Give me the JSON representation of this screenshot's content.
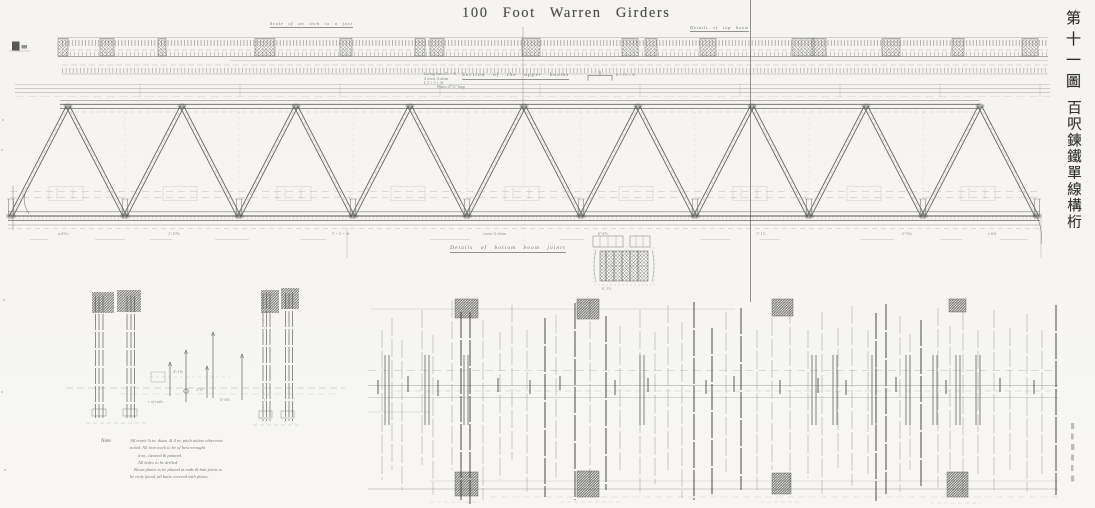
{
  "sheet": {
    "title": "100  Foot  Warren  Girders",
    "side_title_top": "第十一圖",
    "side_title_main": "百呎鍊鐵單線構桁"
  },
  "labels": {
    "scale_top_left": "Scale of an inch to a foot",
    "details_top_right": "Details  of  top  boom",
    "upper_booms": "Section  of  the  upper  booms",
    "bottom_joints": "Details  of  bottom  boom  joints",
    "note_heading": "Note"
  },
  "dimensions": {
    "stack": [
      "Lacing bars 2½ × ⅜",
      "4 rivets ⅞ diam",
      "L 3 × 3 × ⅜"
    ],
    "plate": "Plates 27′ 6″ long",
    "angle": "6 × 3½ × ⅝"
  },
  "annotations": {
    "bottom_band": [
      "a 6⅝ c",
      "1′-10⅞",
      "3 × 3 × ⅜",
      "rivets ⅞ diam",
      "6′-4½",
      "1′-1½",
      "2′-9¾",
      "x 6⅝"
    ],
    "left_detail": [
      "4′-1⅝",
      "2′-6″",
      "6′-4⅞",
      "c of rails"
    ],
    "center_detail": "6′ 1½"
  },
  "notes": {
    "lines": [
      "All rivets ⅞ in. diam. & 4 in. pitch unless otherwise",
      "noted.  All iron work to be of best wrought",
      "iron, cleaned & painted.",
      "All holes to be drilled.",
      "Boom plates to be planed at ends & butt joints to",
      "be truly faced, all butts covered with plates."
    ]
  },
  "colors": {
    "paper": "#f6f5f1",
    "ink_dark": "#3a3a3a",
    "ink_mid": "#666666",
    "ink_faint": "#9a9a9a"
  }
}
